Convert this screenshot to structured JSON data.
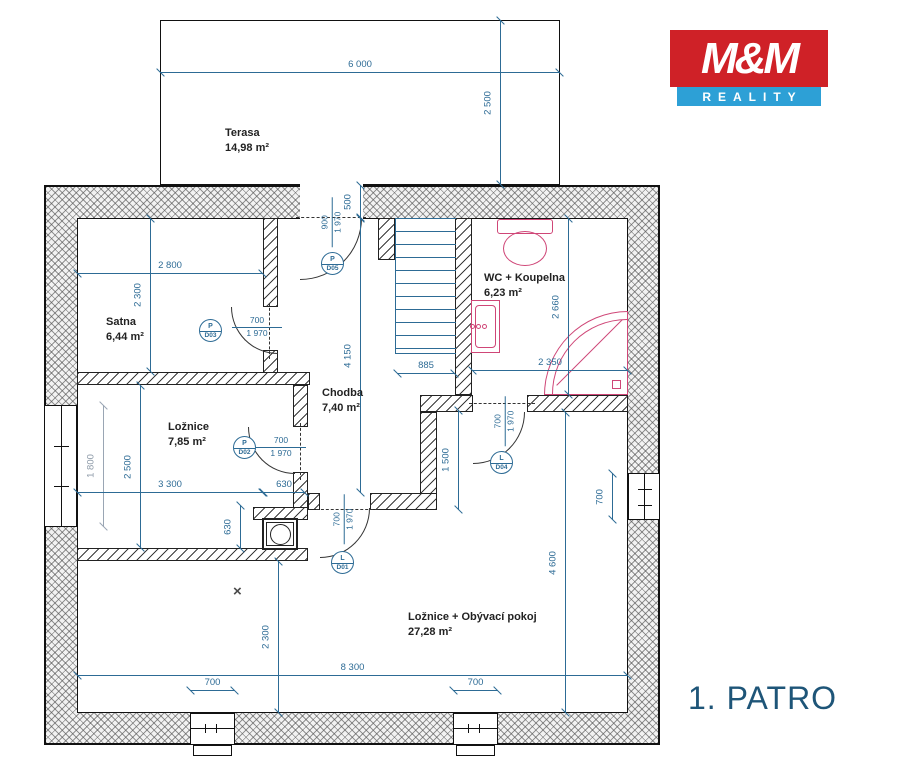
{
  "floor_label": "1. PATRO",
  "logo": {
    "top": "M&M",
    "bottom": "REALITY"
  },
  "rooms": {
    "terasa": {
      "name": "Terasa",
      "area": "14,98 m²"
    },
    "satna": {
      "name": "Satna",
      "area": "6,44 m²"
    },
    "wc": {
      "name": "WC + Koupelna",
      "area": "6,23 m²"
    },
    "chodba": {
      "name": "Chodba",
      "area": "7,40 m²"
    },
    "loznice": {
      "name": "Ložnice",
      "area": "7,85 m²"
    },
    "obyvaci": {
      "name": "Ložnice + Obývací pokoj",
      "area": "27,28 m²"
    }
  },
  "dims": {
    "terasa_width": "6 000",
    "terasa_depth": "2 500",
    "entry_offset": "500",
    "hall_height": "4 150",
    "satna_width": "2 800",
    "satna_height": "2 300",
    "wc_height": "2 660",
    "wc_width": "2 350",
    "loznice_height": "2 500",
    "loznice_window": "1 800",
    "loznice_width": "3 300",
    "loznice_offset": "630",
    "loznice_offset_v": "630",
    "stair_width": "885",
    "hall_lower": "1 500",
    "living_height": "2 300",
    "living_width": "8 300",
    "living_right_height": "4 600",
    "window_left": "700",
    "window_right": "700",
    "window_east": "700"
  },
  "doors": {
    "d01": {
      "letter": "L",
      "code": "D01",
      "w": "700",
      "h": "1 970"
    },
    "d02": {
      "letter": "P",
      "code": "D02",
      "w": "700",
      "h": "1 970"
    },
    "d03": {
      "letter": "P",
      "code": "D03",
      "w": "700",
      "h": "1 970"
    },
    "d04": {
      "letter": "L",
      "code": "D04",
      "w": "700",
      "h": "1 970"
    },
    "d05": {
      "letter": "P",
      "code": "D05",
      "w": "900",
      "h": "1 970"
    }
  },
  "marks": {
    "x_mark": "×"
  },
  "colors": {
    "dimension_blue": "#2d6b95",
    "fixture_pink": "#cf4677",
    "logo_red": "#cf2127",
    "logo_blue": "#2da0d6",
    "floor_text": "#1e5578"
  }
}
